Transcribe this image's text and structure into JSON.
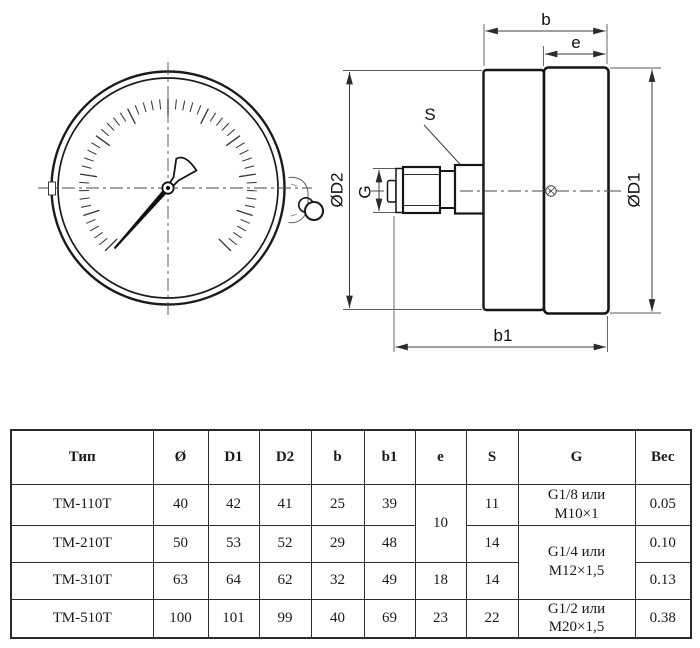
{
  "drawing": {
    "labels": {
      "b": "b",
      "e": "e",
      "s": "S",
      "g": "G",
      "b1": "b1",
      "d1": "ØD1",
      "d2": "ØD2"
    }
  },
  "table": {
    "headers": {
      "type": "Тип",
      "o": "Ø",
      "d1": "D1",
      "d2": "D2",
      "b": "b",
      "b1": "b1",
      "e": "e",
      "s": "S",
      "g": "G",
      "weight": "Вес"
    },
    "rows": [
      {
        "type": "ТМ-110Т",
        "o": "40",
        "d1": "42",
        "d2": "41",
        "b": "25",
        "b1": "39",
        "e": "10",
        "s": "11",
        "g": [
          "G1/8 или",
          "М10×1"
        ],
        "weight": "0.05"
      },
      {
        "type": "ТМ-210Т",
        "o": "50",
        "d1": "53",
        "d2": "52",
        "b": "29",
        "b1": "48",
        "s": "14",
        "g": [
          "G1/4 или",
          "М12×1,5"
        ],
        "weight": "0.10"
      },
      {
        "type": "ТМ-310Т",
        "o": "63",
        "d1": "64",
        "d2": "62",
        "b": "32",
        "b1": "49",
        "e": "18",
        "s": "14",
        "weight": "0.13"
      },
      {
        "type": "ТМ-510Т",
        "o": "100",
        "d1": "101",
        "d2": "99",
        "b": "40",
        "b1": "69",
        "e": "23",
        "s": "22",
        "g": [
          "G1/2 или",
          "М20×1,5"
        ],
        "weight": "0.38"
      }
    ]
  }
}
